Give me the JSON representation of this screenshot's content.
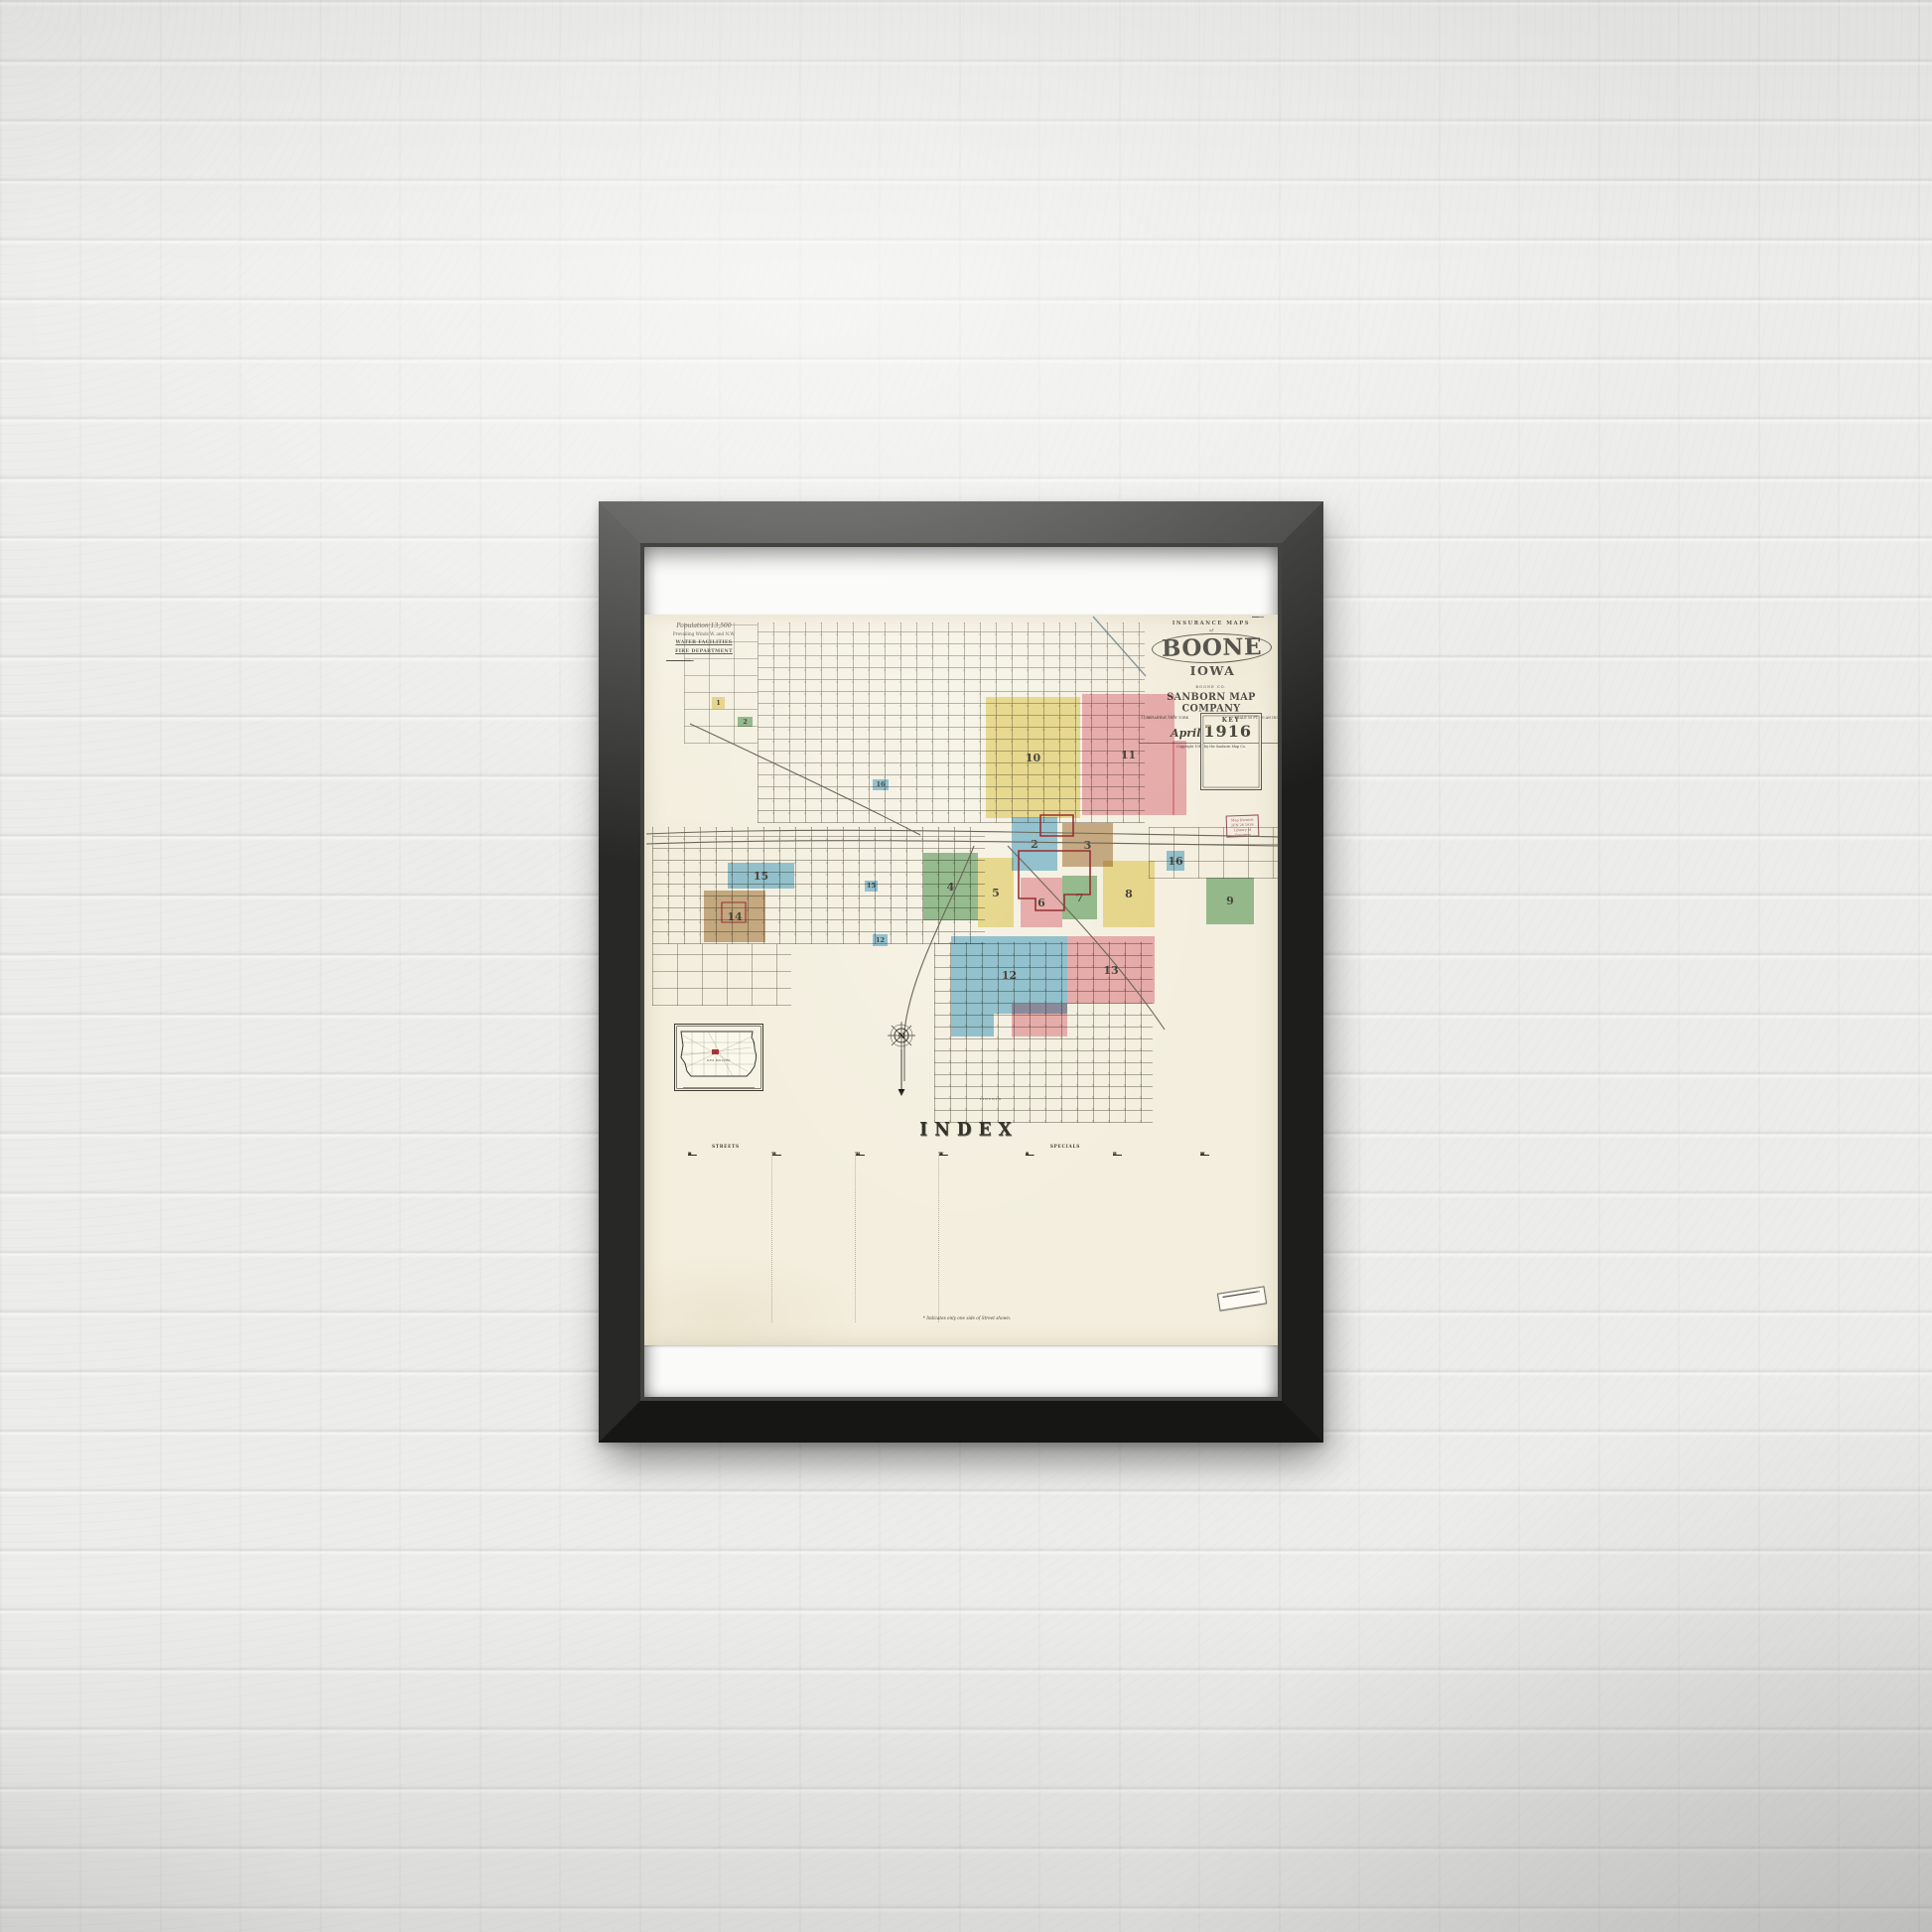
{
  "scene": {
    "wall_color": "#ececea"
  },
  "frame": {
    "color": "#222222",
    "mat_color": "#fafaf8"
  },
  "poster": {
    "paper_color": "#f3eedd",
    "title_block": {
      "series": "INSURANCE MAPS",
      "of": "of",
      "city": "BOONE",
      "state": "IOWA",
      "county": "BOONE CO.",
      "publisher": "SANBORN MAP COMPANY",
      "address": "11 BROADWAY, NEW YORK",
      "scale": "SCALE 50 FT. TO AN INCH",
      "month": "April",
      "year": "1916",
      "copyright": "Copyright 1916 by the Sanborn Map Co."
    },
    "info_block": {
      "population": "Population 13,500",
      "winds": "Prevailing Winds W. and N.W.",
      "water_heading": "WATER FACILITIES",
      "fire_heading": "FIRE DEPARTMENT"
    },
    "key_title": "KEY",
    "stamps": {
      "received_date": "JUN 23 1916",
      "loc_line1": "Map Division",
      "loc_line2": "JUN 28 1916",
      "loc_line3": "Library of Congress"
    },
    "inset_label": "DES MOINES",
    "compass_letter": "N",
    "street_label": "LINCOLN",
    "index": {
      "title": "INDEX",
      "streets_header": "STREETS",
      "specials_header": "SPECIALS",
      "footnote": "* Indicates only one side of Street shown.",
      "street_letters": [
        [
          "A",
          "B",
          "C",
          "D"
        ],
        [
          "E",
          "F",
          "G",
          "H"
        ],
        [
          "J",
          "K",
          "L",
          "M"
        ],
        [
          "N",
          "P",
          "S",
          "W"
        ]
      ],
      "special_letters": [
        [
          "A",
          "B",
          "C",
          "E"
        ],
        [
          "F",
          "G",
          "H",
          "L"
        ],
        [
          "M",
          "P",
          "S",
          "W"
        ]
      ]
    },
    "colors": {
      "yellow": "#eee08e",
      "pink": "#eeaab6",
      "blue": "#87c3e3",
      "green": "#8abb8d",
      "brown": "#c4a67e",
      "boundary_red": "#9a2f33",
      "stamp_red": "#8c3a52",
      "ink": "#3e3c33",
      "line": "#6b675a"
    },
    "districts": [
      {
        "label": "10",
        "color": "yellow",
        "x": 344,
        "y": 83,
        "w": 95,
        "h": 122
      },
      {
        "label": "11",
        "color": "pink",
        "x": 441,
        "y": 80,
        "w": 93,
        "h": 122
      },
      {
        "label": "",
        "color": "pink",
        "x": 532,
        "y": 127,
        "w": 14,
        "h": 75
      },
      {
        "label": "2",
        "color": "blue",
        "x": 370,
        "y": 204,
        "w": 46,
        "h": 54
      },
      {
        "label": "3",
        "color": "brown",
        "x": 421,
        "y": 210,
        "w": 51,
        "h": 44
      },
      {
        "label": "4",
        "color": "green",
        "x": 281,
        "y": 240,
        "w": 55,
        "h": 68
      },
      {
        "label": "5",
        "color": "yellow",
        "x": 336,
        "y": 245,
        "w": 36,
        "h": 70
      },
      {
        "label": "6",
        "color": "pink",
        "x": 379,
        "y": 265,
        "w": 42,
        "h": 50
      },
      {
        "label": "7",
        "color": "green",
        "x": 421,
        "y": 263,
        "w": 35,
        "h": 44
      },
      {
        "label": "8",
        "color": "yellow",
        "x": 462,
        "y": 248,
        "w": 52,
        "h": 67
      },
      {
        "label": "9",
        "color": "green",
        "x": 566,
        "y": 265,
        "w": 48,
        "h": 47
      },
      {
        "label": "12",
        "color": "blue",
        "x": 309,
        "y": 324,
        "w": 117,
        "h": 78
      },
      {
        "label": "",
        "color": "blue",
        "x": 309,
        "y": 402,
        "w": 43,
        "h": 23
      },
      {
        "label": "13",
        "color": "pink",
        "x": 426,
        "y": 324,
        "w": 88,
        "h": 68
      },
      {
        "label": "",
        "color": "pink",
        "x": 370,
        "y": 392,
        "w": 56,
        "h": 33
      },
      {
        "label": "14",
        "color": "brown",
        "x": 60,
        "y": 278,
        "w": 62,
        "h": 52
      },
      {
        "label": "15",
        "color": "blue",
        "x": 84,
        "y": 250,
        "w": 67,
        "h": 26
      },
      {
        "label": "16",
        "color": "blue",
        "x": 526,
        "y": 238,
        "w": 18,
        "h": 20
      },
      {
        "label": "1",
        "color": "yellow",
        "x": 68,
        "y": 83,
        "w": 13,
        "h": 12,
        "small": true
      },
      {
        "label": "2",
        "color": "green",
        "x": 94,
        "y": 103,
        "w": 15,
        "h": 10,
        "small": true
      },
      {
        "label": "16",
        "color": "blue",
        "x": 230,
        "y": 166,
        "w": 16,
        "h": 11,
        "small": true
      },
      {
        "label": "15",
        "color": "blue",
        "x": 222,
        "y": 268,
        "w": 13,
        "h": 11,
        "small": true
      },
      {
        "label": "12",
        "color": "blue",
        "x": 230,
        "y": 322,
        "w": 15,
        "h": 12,
        "small": true
      }
    ]
  }
}
